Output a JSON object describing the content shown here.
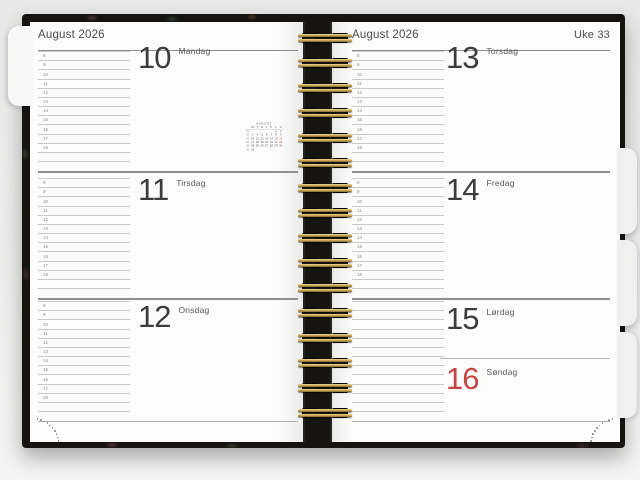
{
  "left_page": {
    "month_year": "August 2026",
    "days": [
      {
        "number": "10",
        "weekday": "Mandag"
      },
      {
        "number": "11",
        "weekday": "Tirsdag"
      },
      {
        "number": "12",
        "weekday": "Onsdag"
      }
    ],
    "mini_calendar": {
      "title": "AUGUST",
      "weekday_header": [
        "M",
        "T",
        "O",
        "T",
        "F",
        "L",
        "S"
      ],
      "weeks": [
        {
          "week": "31",
          "days": [
            "",
            "",
            "",
            "",
            "",
            "1",
            "2"
          ]
        },
        {
          "week": "32",
          "days": [
            "3",
            "4",
            "5",
            "6",
            "7",
            "8",
            "9"
          ]
        },
        {
          "week": "33",
          "days": [
            "10",
            "11",
            "12",
            "13",
            "14",
            "15",
            "16"
          ]
        },
        {
          "week": "34",
          "days": [
            "17",
            "18",
            "19",
            "20",
            "21",
            "22",
            "23"
          ]
        },
        {
          "week": "35",
          "days": [
            "24",
            "25",
            "26",
            "27",
            "28",
            "29",
            "30"
          ]
        },
        {
          "week": "36",
          "days": [
            "31",
            "",
            "",
            "",
            "",
            "",
            ""
          ]
        }
      ]
    }
  },
  "right_page": {
    "month_year": "August 2026",
    "week_label": "Uke 33",
    "days": [
      {
        "number": "13",
        "weekday": "Torsdag"
      },
      {
        "number": "14",
        "weekday": "Fredag"
      },
      {
        "number": "15",
        "weekday": "Lørdag"
      },
      {
        "number": "16",
        "weekday": "Søndag",
        "highlight": true
      }
    ]
  },
  "hours": [
    "8",
    "9",
    "10",
    "11",
    "12",
    "13",
    "14",
    "15",
    "16",
    "17",
    "18"
  ],
  "colors": {
    "sunday_red": "#c64545",
    "wire_gold": "#c9a95c",
    "cover_dark": "#16140f",
    "page_white": "#fcfcfb"
  }
}
